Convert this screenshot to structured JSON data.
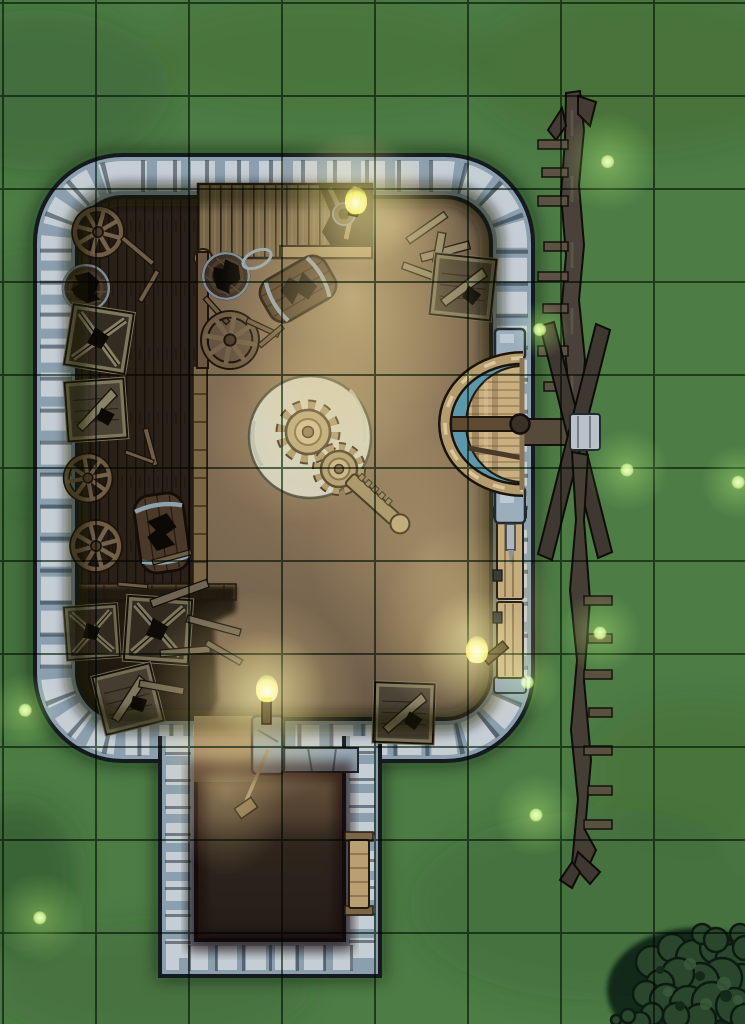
{
  "meta": {
    "asset_type": "top-down RPG battle map",
    "scene": "ruined stone windmill at night",
    "dimensions_px": {
      "width": 745,
      "height": 1024
    }
  },
  "grid": {
    "cell_size_px": 93,
    "offset_x": 2,
    "offset_y": 2,
    "columns": 8,
    "rows": 11,
    "line_color": "#1d3d22"
  },
  "palette": {
    "grass": "#4d7c45",
    "grass_dark": "#2c4b28",
    "grid_line": "#1d3d22",
    "stone_light": "#c5ced4",
    "stone_mid": "#8b9fae",
    "stone_dark": "#1a2128",
    "dirt_lit": "#c9b287",
    "dirt_mid": "#77644e",
    "dirt_dark": "#3c3128",
    "wood_floor": "#33281e",
    "wood_beam": "#7b6746",
    "wood_object": "#7e775c",
    "millstone": "#d7dbd0",
    "gear": "#b3a077",
    "water_blue": "#5d97ac",
    "sail_wood": "#474037",
    "flame_yellow": "#e9e44c",
    "firefly_green": "#9ee24f",
    "bush_green": "#2a472e"
  },
  "structures": {
    "building": {
      "label": "mill house",
      "walls": "stone",
      "floors": [
        "dirt",
        "wooden planks (west side)"
      ],
      "annex": "southern store room with side door",
      "doors": [
        {
          "id": "east-door",
          "side": "east wall",
          "state": "closed"
        },
        {
          "id": "annex-door",
          "side": "east wall of south annex",
          "state": "closed"
        }
      ]
    },
    "windmill": {
      "label": "windmill sails and axle",
      "position": "along east exterior wall",
      "parts": [
        "upper sail",
        "hub cross",
        "lower sail",
        "brake wheel"
      ]
    }
  },
  "objects": [
    {
      "name": "millstone-with-gears",
      "desc": "large pale millstone, two gears and a toothed lever"
    },
    {
      "name": "brake-wheel",
      "desc": "half wheel with blue race at east wall driving the sails"
    },
    {
      "name": "loading-platform",
      "desc": "broken slatted wooden platform along north wall"
    },
    {
      "name": "cart-wheels",
      "count": 4
    },
    {
      "name": "barrels",
      "count": 5,
      "state": "mostly broken"
    },
    {
      "name": "crates",
      "count": 7,
      "state": "broken"
    },
    {
      "name": "barrel-hoop",
      "count": 1
    },
    {
      "name": "railing-post",
      "desc": "post with knob below platform"
    },
    {
      "name": "broom",
      "position": "annex entrance"
    },
    {
      "name": "debris-pile",
      "position": "southwest corner"
    },
    {
      "name": "bushes",
      "position": "southeast map corner"
    }
  ],
  "lights": {
    "torches": [
      {
        "x": 356,
        "y": 202,
        "s": 1.15
      },
      {
        "x": 267,
        "y": 690,
        "s": 1.0
      },
      {
        "x": 477,
        "y": 651,
        "s": 1.0
      }
    ],
    "fireflies": [
      {
        "x": 608,
        "y": 162,
        "s": 1.2
      },
      {
        "x": 540,
        "y": 330,
        "s": 0.7
      },
      {
        "x": 627,
        "y": 470,
        "s": 1.0
      },
      {
        "x": 738,
        "y": 482,
        "s": 0.9
      },
      {
        "x": 600,
        "y": 633,
        "s": 1.0
      },
      {
        "x": 527,
        "y": 682,
        "s": 0.85
      },
      {
        "x": 536,
        "y": 815,
        "s": 1.0
      },
      {
        "x": 25,
        "y": 710,
        "s": 0.9
      },
      {
        "x": 40,
        "y": 918,
        "s": 1.1
      }
    ]
  }
}
